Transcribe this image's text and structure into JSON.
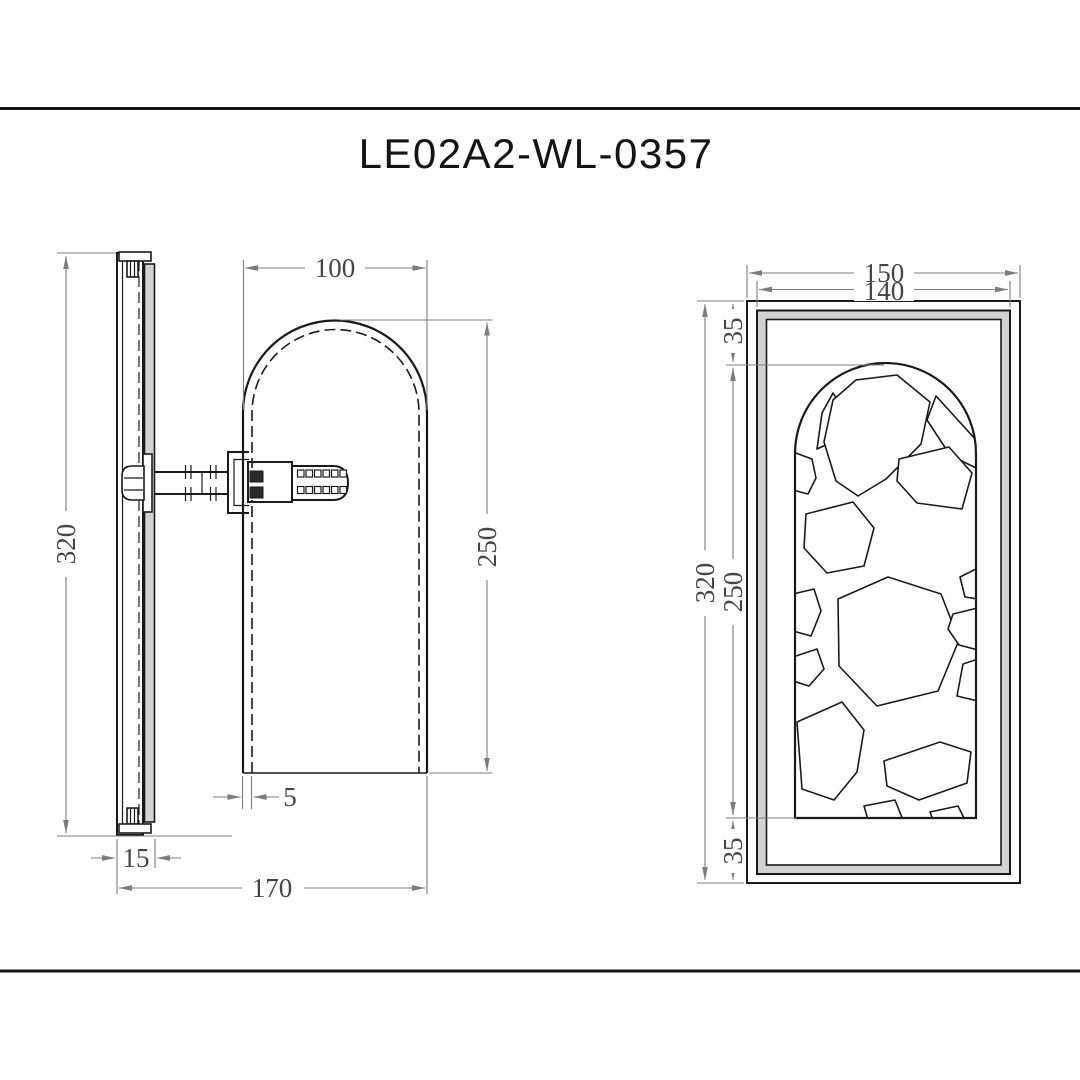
{
  "title": "LE02A2-WL-0357",
  "side_view": {
    "height": "320",
    "shade_width": "100",
    "shade_height": "250",
    "shade_offset": "5",
    "plate_depth": "15",
    "total_depth": "170"
  },
  "front_view": {
    "outer_width": "150",
    "inner_width": "140",
    "height": "320",
    "window_height": "250",
    "top_inset": "35",
    "bottom_inset": "35"
  },
  "colors": {
    "object_line": "#1a1a1a",
    "dimension_line": "#7c7c7c",
    "dimension_text": "#454545",
    "panel_fill": "#d2d2d2",
    "background": "#ffffff"
  }
}
